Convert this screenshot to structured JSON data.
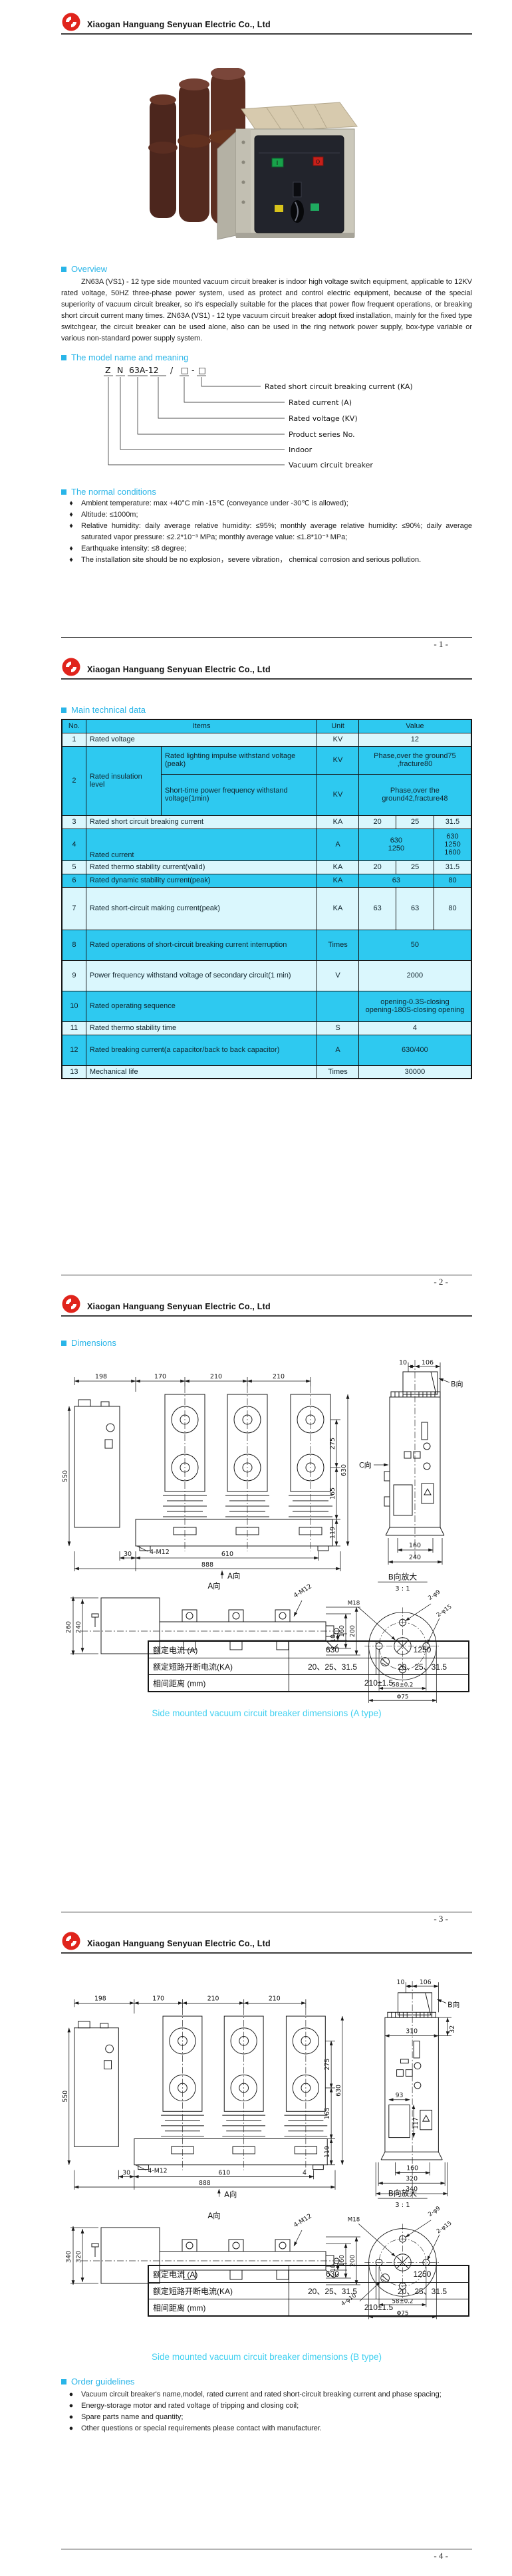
{
  "company": "Xiaogan Hanguang Senyuan Electric Co., Ltd",
  "colors": {
    "accent": "#29b5e8",
    "caption": "#41d0f0",
    "table_header": "#2ec9f0",
    "row_light": "#daf7fd",
    "row_cyan": "#2ec9f0",
    "logo_red": "#e0241c"
  },
  "photo": {
    "btn_on": "I",
    "btn_off": "O"
  },
  "p1": {
    "pageno": "- 1 -",
    "overview_title": "Overview",
    "overview_text": "ZN63A (VS1) - 12 type side mounted vacuum circuit breaker is indoor high voltage switch equipment, applicable to 12KV rated voltage, 50HZ three-phase power system, used as protect and control electric equipment, because of the special superiority of vacuum circuit breaker, so it's especially suitable for the places that power flow frequent operations, or breaking short circuit current many times. ZN63A (VS1) - 12 type vacuum circuit breaker adopt fixed installation, mainly for the fixed type switchgear, the circuit breaker can be used alone, also can be used in the ring network power supply, box-type variable or various non-standard power supply system.",
    "model_title": "The model name and meaning",
    "model": {
      "parts": [
        "Z",
        "N",
        "63A-12",
        "/",
        "□",
        "-",
        "□"
      ],
      "labels": [
        "Rated short circuit breaking current (KA)",
        "Rated current (A)",
        "Rated voltage (KV)",
        "Product series No.",
        "Indoor",
        "Vacuum circuit breaker"
      ]
    },
    "cond_title": "The normal conditions",
    "bullet": "♦",
    "conditions": [
      "Ambient temperature: max +40°C min -15℃ (conveyance under -30℃ is allowed);",
      "Altitude: ≤1000m;",
      "Relative humidity: daily average relative humidity: ≤95%; monthly average relative humidity: ≤90%; daily average saturated vapor pressure: ≤2.2*10⁻³ MPa; monthly average value: ≤1.8*10⁻³ MPa;",
      "Earthquake intensity: ≤8 degree;",
      "The installation site should be no explosion，severe vibration， chemical corrosion and serious pollution."
    ]
  },
  "p2": {
    "pageno": "- 2 -",
    "title": "Main technical data",
    "head": {
      "no": "No.",
      "items": "Items",
      "unit": "Unit",
      "value": "Value"
    },
    "rows": {
      "r1": {
        "no": "1",
        "item": "Rated voltage",
        "unit": "KV",
        "value": "12"
      },
      "r2": {
        "no": "2",
        "item": "Rated insulation level",
        "sub1": "Rated lighting impulse withstand voltage (peak)",
        "unit1": "KV",
        "val1": "Phase,over the ground75 ,fracture80",
        "sub2": "Short-time power frequency withstand voltage(1min)",
        "unit2": "KV",
        "val2": "Phase,over the ground42,fracture48"
      },
      "r3": {
        "no": "3",
        "item": "Rated short circuit breaking current",
        "unit": "KA",
        "v1": "20",
        "v2": "25",
        "v3": "31.5"
      },
      "r4": {
        "no": "4",
        "item": "Rated current",
        "unit": "A",
        "v12a": "630",
        "v12b": "1250",
        "v3a": "630 1250",
        "v3b": "1600"
      },
      "r5": {
        "no": "5",
        "item": "Rated thermo stability current(valid)",
        "unit": "KA",
        "v1": "20",
        "v2": "25",
        "v3": "31.5"
      },
      "r6": {
        "no": "6",
        "item": "Rated dynamic stability current(peak)",
        "unit": "KA",
        "v12": "63",
        "v3": "80"
      },
      "r7": {
        "no": "7",
        "item": "Rated short-circuit making current(peak)",
        "unit": "KA",
        "v1": "63",
        "v2": "63",
        "v3": "80"
      },
      "r8": {
        "no": "8",
        "item": "Rated operations of short-circuit breaking current interruption",
        "unit": "Times",
        "value": "50"
      },
      "r9": {
        "no": "9",
        "item": "Power frequency withstand voltage of secondary circuit(1 min)",
        "unit": "V",
        "value": "2000"
      },
      "r10": {
        "no": "10",
        "item": "Rated operating sequence",
        "unit": "",
        "va": "opening-0.3S-closing",
        "vb": "opening-180S-closing opening"
      },
      "r11": {
        "no": "11",
        "item": "Rated thermo stability time",
        "unit": "S",
        "value": "4"
      },
      "r12": {
        "no": "12",
        "item": "Rated breaking current(a capacitor/back to back capacitor)",
        "unit": "A",
        "value": "630/400"
      },
      "r13": {
        "no": "13",
        "item": "Mechanical life",
        "unit": "Times",
        "value": "30000"
      }
    }
  },
  "p3": {
    "pageno": "- 3 -",
    "title": "Dimensions",
    "front": {
      "top": [
        "198",
        "170",
        "210",
        "210"
      ],
      "left": "550",
      "right": [
        "275",
        "165",
        "119",
        "630"
      ],
      "bottom": [
        "30",
        "610",
        "888"
      ],
      "bolt": "4-M12",
      "view": "A向"
    },
    "side": {
      "top": [
        "10",
        "106"
      ],
      "b": "B向",
      "c": "C向",
      "bottom": [
        "160",
        "240"
      ]
    },
    "aview": {
      "title": "A向",
      "left": [
        "260",
        "240"
      ],
      "right": [
        "10",
        "160",
        "200"
      ],
      "bolt": "4-M12"
    },
    "detail": {
      "title": "B向放大",
      "scale": "3 : 1",
      "m18": "M18",
      "phi9": "2-φ9",
      "phi15": "2-φ15",
      "d58": "58±0.2",
      "d75": "Φ75"
    },
    "spec": {
      "r1": [
        "额定电流 (A)",
        "630",
        "1250"
      ],
      "r2": [
        "额定短路开断电流(KA)",
        "20、25、31.5",
        "20、25、31.5"
      ],
      "r3": [
        "相间距离 (mm)",
        "210±1.5"
      ]
    },
    "caption": "Side mounted vacuum circuit breaker dimensions (A type)"
  },
  "p4": {
    "pageno": "- 4 -",
    "front": {
      "top": [
        "198",
        "170",
        "210",
        "210"
      ],
      "left": "550",
      "right": [
        "275",
        "165",
        "119",
        "630"
      ],
      "bottom": [
        "30",
        "610",
        "888"
      ],
      "bolt": "4-M12",
      "view": "A向",
      "extra": "4"
    },
    "side": {
      "top": [
        "10",
        "106"
      ],
      "b": "B向",
      "upper": [
        "310",
        "32"
      ],
      "inner": [
        "93",
        "117"
      ],
      "bottom": [
        "160",
        "320",
        "340"
      ]
    },
    "aview": {
      "title": "A向",
      "left": [
        "340",
        "320"
      ],
      "right": [
        "10",
        "160",
        "200"
      ],
      "bolt": "4-M12"
    },
    "detail": {
      "title": "B向放大",
      "scale": "3 : 1",
      "m18": "M18",
      "phi9": "2-φ9",
      "phi15": "2-φ15",
      "phi10": "4-φ10",
      "d58": "58±0.2",
      "d75": "Φ75"
    },
    "spec": {
      "r1": [
        "额定电流 (A)",
        "630",
        "1250"
      ],
      "r2": [
        "额定短路开断电流(KA)",
        "20、25、31.5",
        "20、25、31.5"
      ],
      "r3": [
        "相间距离 (mm)",
        "210±1.5"
      ]
    },
    "caption": "Side mounted vacuum circuit breaker dimensions (B type)",
    "order_title": "Order guidelines",
    "bullet": "●",
    "order": [
      "Vacuum circuit breaker's name,model, rated current and rated short-circuit breaking current and phase spacing;",
      "Energy-storage motor and rated voltage of tripping and closing coil;",
      "Spare parts name and quantity;",
      "Other questions or special requirements please contact with manufacturer."
    ]
  }
}
